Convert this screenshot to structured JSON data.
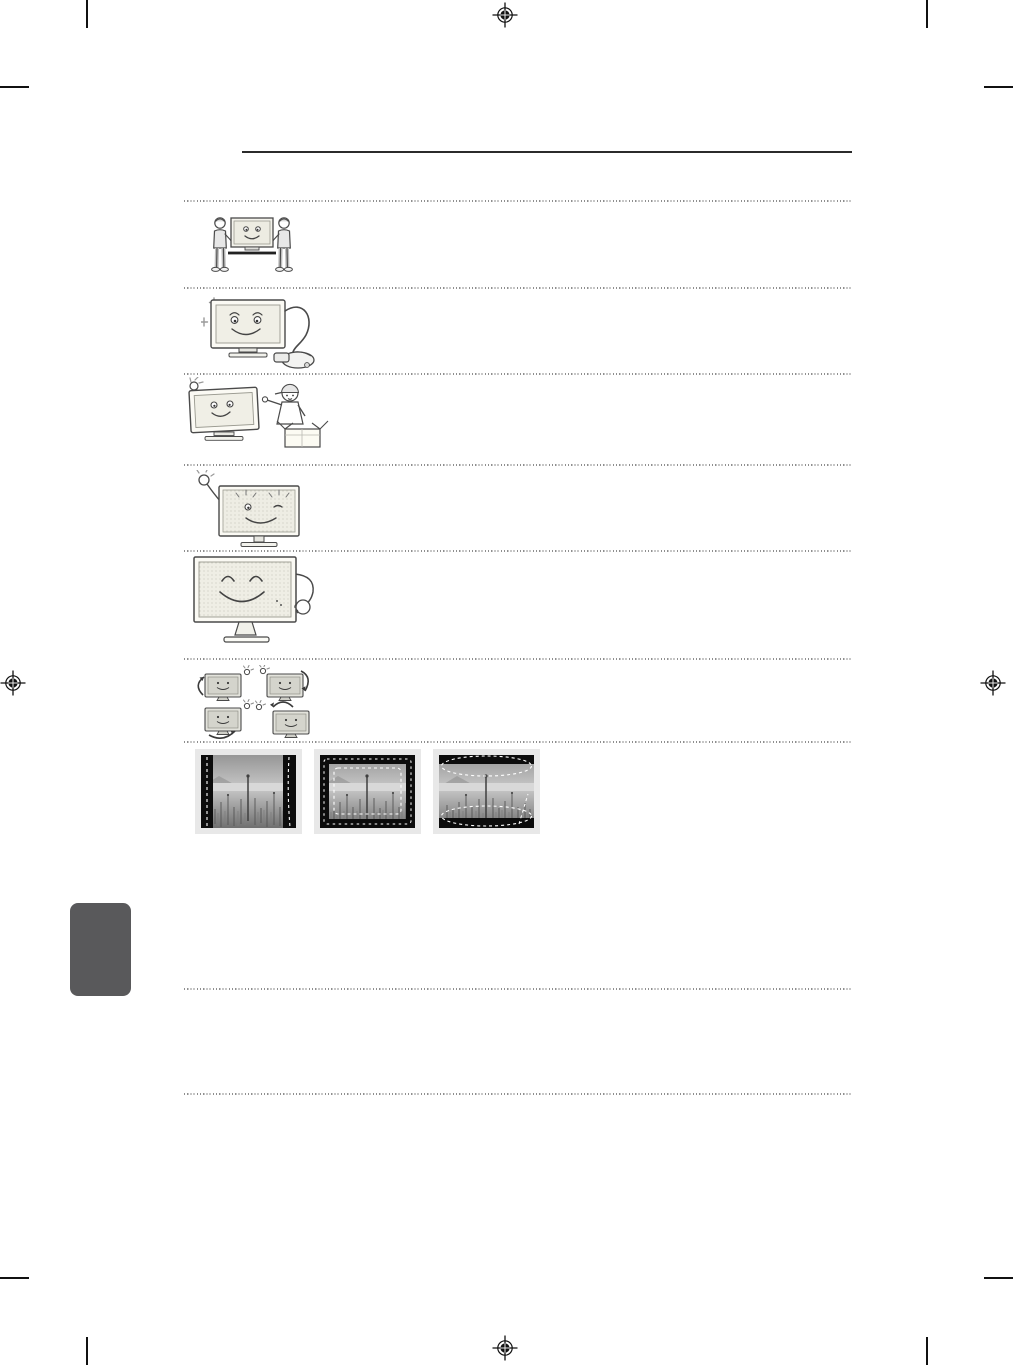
{
  "page": {
    "kind": "printed-manual-safety-page-proof",
    "background": "#ffffff",
    "visible_text": ""
  },
  "colors": {
    "title_rule": "#2b2b2b",
    "dotted_separator": "#8f8f8f",
    "crop_mark": "#111111",
    "side_tab": "#59595b",
    "photo_frame": "#e8e8e8",
    "illustration_line": "#4a4a4a"
  },
  "print_marks": {
    "registration_marks": [
      {
        "icon": "registration-target-icon",
        "position": "top-center"
      },
      {
        "icon": "registration-target-icon",
        "position": "left-middle"
      },
      {
        "icon": "registration-target-icon",
        "position": "right-middle"
      },
      {
        "icon": "registration-target-icon",
        "position": "bottom-center"
      }
    ],
    "crop_marks": [
      "top-left",
      "top-right",
      "bottom-left",
      "bottom-right"
    ]
  },
  "header": {
    "has_title_rule": true
  },
  "rows": [
    {
      "icon": "two-people-carrying-tv-illustration"
    },
    {
      "icon": "tv-with-vacuum-cleaner-illustration"
    },
    {
      "icon": "tv-and-service-technician-with-box-illustration"
    },
    {
      "icon": "hand-waving-at-winking-tv-illustration"
    },
    {
      "icon": "smiling-tv-with-hand-illustration"
    },
    {
      "icon": "four-tv-rotation-positions-illustration"
    },
    {
      "icon": "screen-burn-in-example-photos",
      "photos": [
        {
          "icon": "pillarbox-sidebars-burn-in-photo"
        },
        {
          "icon": "window-border-burn-in-photo"
        },
        {
          "icon": "letterbox-topbottom-burn-in-photo"
        }
      ]
    }
  ],
  "side_tab": {
    "icon": "page-edge-tab"
  }
}
